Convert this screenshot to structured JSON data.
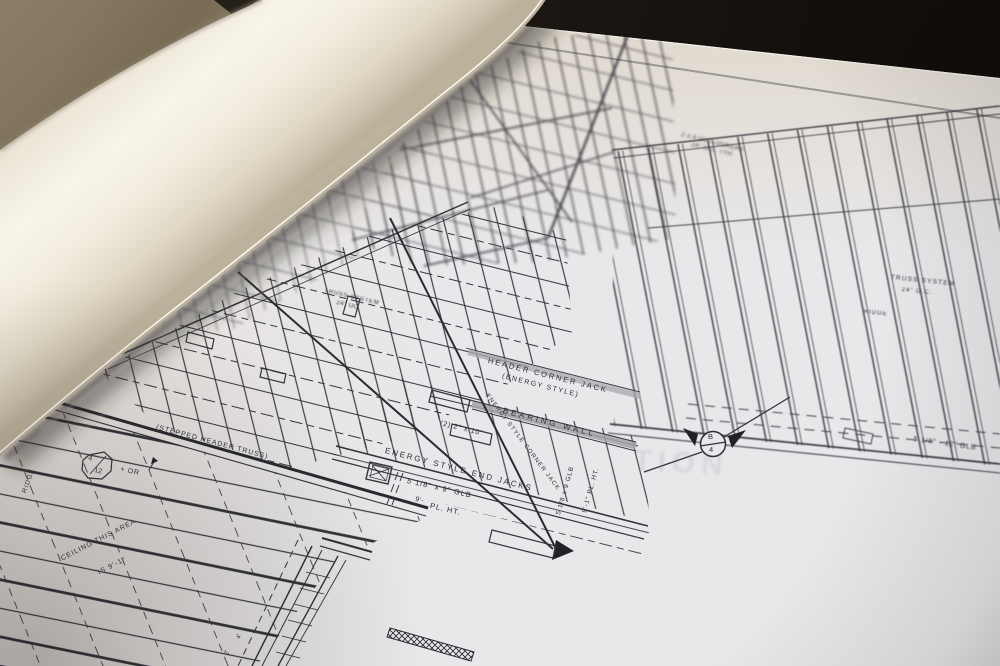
{
  "photo": {
    "colors": {
      "background_black": "#14100d",
      "table_tan": "#8d7f66",
      "paper_roll_cream": "#f7f3e9",
      "sheet_gray_white": "#e8e7e9",
      "ink": "#34333a"
    }
  },
  "blueprint": {
    "labels": {
      "header_corner_jack_line1": "HEADER CORNER JACK",
      "header_corner_jack_line2": "(ENERGY STYLE)",
      "bearing_wall": "BEARING WALL",
      "header_size": "(2) 2\" x 10\"",
      "end_jacks": "ENERGY STYLE END JACKS",
      "corner_jack_diagonal": "ENERGY STYLE CORNER JACK",
      "glb_beam": "5 1/8\" x 9\" GLB",
      "plate_height_prefix": "9'-",
      "plate_height": "PL. HT.",
      "glb_beam_vertical": "5 1/8 x 9 GLB",
      "plate_height_vertical": "9'-1\" PL. HT.",
      "stepped_header_truss": "(STEPPED HEADER TRUSS)",
      "truss_system_left_line1": "TRUSS SYSTEM",
      "truss_system_left_line2": "24\" OC",
      "truss_system_right_line1": "TRUSS SYSTEM",
      "truss_system_right_line2": "24\" O.C.",
      "ridge_right": "RIDGE",
      "ridge_left": "RIDGE",
      "pitch_numerator": "4",
      "pitch_denominator": "12",
      "pitch_note": "+ OR",
      "ceiling_line1": "CEILING THIS AREA",
      "ceiling_line2": "IS 9'-1\"",
      "glb_right": "5 1/8\" - 12\" GLB",
      "section_marker_letter": "B",
      "section_marker_number": "4",
      "outlookers_line1": "2 x 4 OUTLOOKERS",
      "outlookers_line2": "24\" O.C. TYP.",
      "dim_a": "4'",
      "dim_b": "2'",
      "watermark": "TION"
    }
  }
}
